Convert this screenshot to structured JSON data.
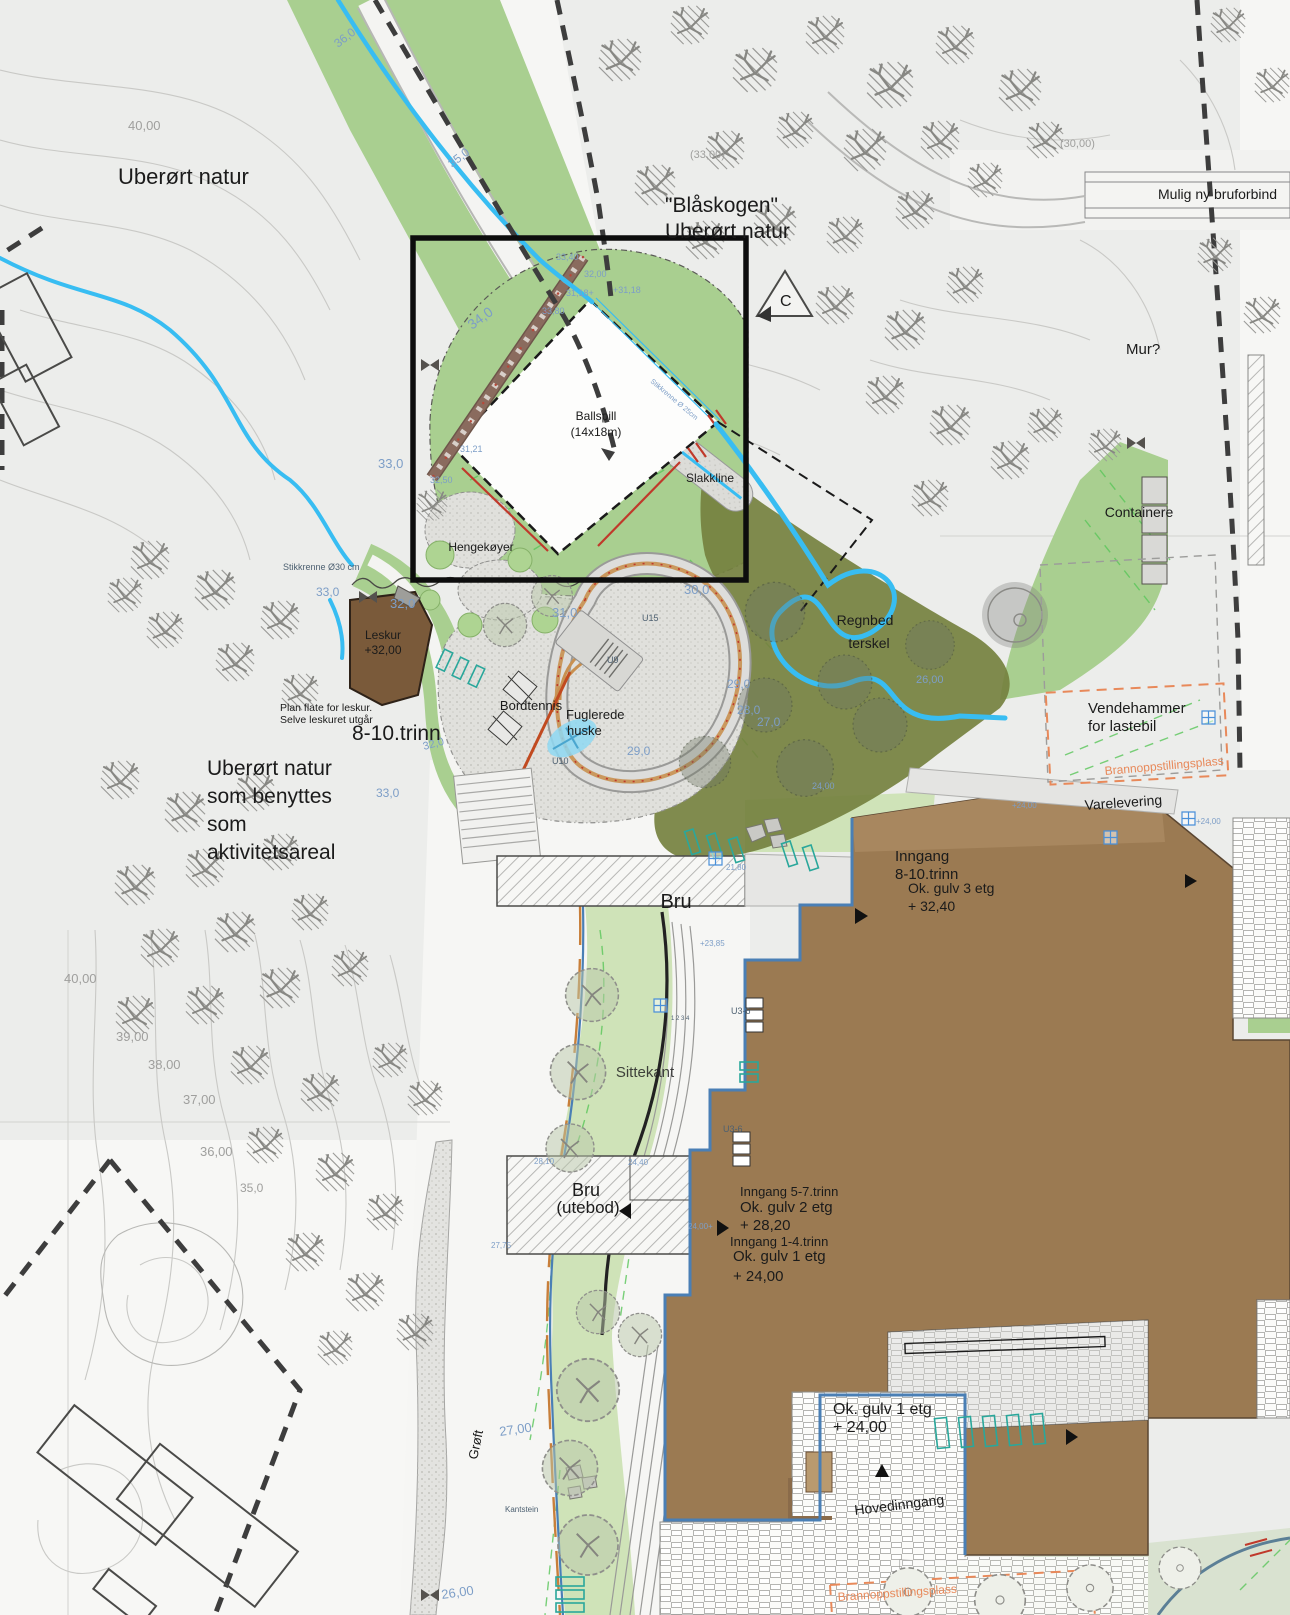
{
  "colors": {
    "terrain": "#ecedeb",
    "slope_green": "#a9cf90",
    "lawn_green": "#cfe3b8",
    "pale_green": "#d9e2d0",
    "rain_garden_olive": "#75813f",
    "water_blue": "#38bdf2",
    "building_brown": "#9b7a52",
    "building_brown_light": "#a8875f",
    "leskur_brown": "#7a5a3a",
    "accent_orange": "#e8895a",
    "curb_orange": "#c87f3a",
    "track_tan": "#c89050",
    "red_line": "#c0392b",
    "boundary_dark": "#3d3d3d",
    "elevation_blue": "#7d9ec7",
    "contour_grey": "#9f9f9d"
  },
  "labels": {
    "uberort_natur_top": "Uberørt natur",
    "blaskogen_1": "\"Blåskogen\"",
    "blaskogen_2": "Uberørt natur",
    "mulig_ny_bru": "Mulig ny bruforbind",
    "mur": "Mur?",
    "section_c": "C",
    "ballspill_1": "Ballspill",
    "ballspill_2": "(14x18m)",
    "slakkline": "Slakkline",
    "hengekoyer": "Hengekøyer",
    "leskur_1": "Leskur",
    "leskur_2": "+32,00",
    "plan_flate_1": "Plan flate for leskur.",
    "plan_flate_2": "Selve leskuret utgår",
    "trinn_8_10": "8-10.trinn",
    "natur_1": "Uberørt natur",
    "natur_2": "som benyttes",
    "natur_3": "som",
    "natur_4": "aktivitetsareal",
    "bordtennis": "Bordtennis",
    "fuglerede_1": "Fuglerede",
    "fuglerede_2": "huske",
    "regnbed_1": "Regnbed",
    "regnbed_2": "terskel",
    "containere": "Containere",
    "vendehammer_1": "Vendehammer",
    "vendehammer_2": "for lastebil",
    "brannoppstillingsplass": "Brannoppstillingsplass",
    "varelevering": "Varelevering",
    "inngang_810_1": "Inngang",
    "inngang_810_2": "8-10.trinn",
    "ok_gulv3_1": "Ok. gulv 3 etg",
    "ok_gulv3_2": "+ 32,40",
    "bru": "Bru",
    "sittekant": "Sittekant",
    "bru_utebod_1": "Bru",
    "bru_utebod_2": "(utebod)",
    "inngang_57": "Inngang 5-7.trinn",
    "ok_gulv2_1": "Ok. gulv 2 etg",
    "ok_gulv2_2": "+ 28,20",
    "inngang_14": "Inngang 1-4.trinn",
    "ok_gulv1_1": "Ok. gulv 1 etg",
    "ok_gulv1_2": "+ 24,00",
    "ok_gulv1b_1": "Ok. gulv 1 etg",
    "ok_gulv1b_2": "+ 24,00",
    "hovedinngang": "Hovedinngang",
    "groft": "Grøft"
  },
  "map": {
    "spot_labels": [
      {
        "t": "40,00",
        "x": 128,
        "y": 130,
        "fs": 13,
        "c": "g"
      },
      {
        "t": "36,0",
        "x": 338,
        "y": 48,
        "fs": 12,
        "c": "b",
        "r": -38
      },
      {
        "t": "35,0",
        "x": 452,
        "y": 168,
        "fs": 12,
        "c": "b",
        "r": -38
      },
      {
        "t": "(33,00)",
        "x": 690,
        "y": 158,
        "fs": 11,
        "c": "g"
      },
      {
        "t": "(30,00)",
        "x": 1060,
        "y": 147,
        "fs": 11,
        "c": "g"
      },
      {
        "t": "34,0",
        "x": 472,
        "y": 330,
        "fs": 14,
        "c": "b",
        "r": -36
      },
      {
        "t": "33,40",
        "x": 556,
        "y": 260,
        "fs": 9,
        "c": "b"
      },
      {
        "t": "32,00",
        "x": 584,
        "y": 277,
        "fs": 9,
        "c": "b"
      },
      {
        "t": "31,18+",
        "x": 566,
        "y": 296,
        "fs": 9,
        "c": "b"
      },
      {
        "t": "+31,18",
        "x": 613,
        "y": 293,
        "fs": 9,
        "c": "b"
      },
      {
        "t": "33,80",
        "x": 542,
        "y": 314,
        "fs": 9,
        "c": "b"
      },
      {
        "t": "31,21",
        "x": 460,
        "y": 452,
        "fs": 9,
        "c": "b"
      },
      {
        "t": "32,50",
        "x": 430,
        "y": 483,
        "fs": 9,
        "c": "b"
      },
      {
        "t": "33,0",
        "x": 378,
        "y": 468,
        "fs": 13,
        "c": "b"
      },
      {
        "t": "33,0",
        "x": 316,
        "y": 596,
        "fs": 12,
        "c": "b"
      },
      {
        "t": "32,0",
        "x": 390,
        "y": 608,
        "fs": 13,
        "c": "b"
      },
      {
        "t": "31,0",
        "x": 552,
        "y": 617,
        "fs": 13,
        "c": "b"
      },
      {
        "t": "30,0",
        "x": 684,
        "y": 594,
        "fs": 13,
        "c": "b"
      },
      {
        "t": "33,0",
        "x": 376,
        "y": 797,
        "fs": 12,
        "c": "b"
      },
      {
        "t": "32,0",
        "x": 424,
        "y": 750,
        "fs": 11,
        "c": "b",
        "r": -15
      },
      {
        "t": "29,0",
        "x": 627,
        "y": 755,
        "fs": 12,
        "c": "b"
      },
      {
        "t": "29,0",
        "x": 727,
        "y": 688,
        "fs": 12,
        "c": "b"
      },
      {
        "t": "28,0",
        "x": 737,
        "y": 714,
        "fs": 12,
        "c": "b"
      },
      {
        "t": "27,0",
        "x": 757,
        "y": 726,
        "fs": 12,
        "c": "b"
      },
      {
        "t": "26,00",
        "x": 916,
        "y": 683,
        "fs": 11,
        "c": "b"
      },
      {
        "t": "24,00",
        "x": 812,
        "y": 789,
        "fs": 9,
        "c": "b"
      },
      {
        "t": "+24,00",
        "x": 1012,
        "y": 808,
        "fs": 8,
        "c": "b"
      },
      {
        "t": "+24,00",
        "x": 1196,
        "y": 824,
        "fs": 8,
        "c": "b"
      },
      {
        "t": "21,80",
        "x": 726,
        "y": 870,
        "fs": 8,
        "c": "b"
      },
      {
        "t": "+23,85",
        "x": 700,
        "y": 946,
        "fs": 8,
        "c": "b"
      },
      {
        "t": "28,10",
        "x": 534,
        "y": 1164,
        "fs": 8,
        "c": "b"
      },
      {
        "t": "24,40",
        "x": 628,
        "y": 1165,
        "fs": 8,
        "c": "b"
      },
      {
        "t": "27,75",
        "x": 491,
        "y": 1248,
        "fs": 8,
        "c": "b"
      },
      {
        "t": "24,00+",
        "x": 688,
        "y": 1229,
        "fs": 8,
        "c": "b"
      },
      {
        "t": "27,00",
        "x": 500,
        "y": 1436,
        "fs": 13,
        "c": "b",
        "r": -8
      },
      {
        "t": "26,00",
        "x": 442,
        "y": 1599,
        "fs": 13,
        "c": "b",
        "r": -8
      },
      {
        "t": "40,00",
        "x": 64,
        "y": 983,
        "fs": 13,
        "c": "g"
      },
      {
        "t": "39,00",
        "x": 116,
        "y": 1041,
        "fs": 13,
        "c": "g"
      },
      {
        "t": "38,00",
        "x": 148,
        "y": 1069,
        "fs": 13,
        "c": "g"
      },
      {
        "t": "37,00",
        "x": 183,
        "y": 1104,
        "fs": 13,
        "c": "g"
      },
      {
        "t": "36,00",
        "x": 200,
        "y": 1156,
        "fs": 13,
        "c": "g"
      },
      {
        "t": "35,0",
        "x": 240,
        "y": 1192,
        "fs": 12,
        "c": "g"
      },
      {
        "t": "Stikkrenne Ø30 cm",
        "x": 283,
        "y": 570,
        "fs": 9,
        "c": "d"
      },
      {
        "t": "Stikkrenne Ø 25cm",
        "x": 650,
        "y": 382,
        "fs": 7,
        "c": "b",
        "r": 40
      },
      {
        "t": "Kantstein",
        "x": 505,
        "y": 1512,
        "fs": 8,
        "c": "d"
      },
      {
        "t": "1 2 3 4",
        "x": 671,
        "y": 1020,
        "fs": 6,
        "c": "d"
      },
      {
        "t": "U9",
        "x": 607,
        "y": 663,
        "fs": 9,
        "c": "d"
      },
      {
        "t": "U15",
        "x": 642,
        "y": 621,
        "fs": 9,
        "c": "d"
      },
      {
        "t": "U10",
        "x": 552,
        "y": 764,
        "fs": 9,
        "c": "d"
      },
      {
        "t": "U3-6",
        "x": 731,
        "y": 1014,
        "fs": 9,
        "c": "d"
      },
      {
        "t": "U3-6",
        "x": 723,
        "y": 1132,
        "fs": 9,
        "c": "d"
      }
    ],
    "trees": [
      {
        "v": "h",
        "x": 620,
        "y": 60,
        "s": 1.1
      },
      {
        "v": "h",
        "x": 690,
        "y": 25,
        "s": 1
      },
      {
        "v": "h",
        "x": 755,
        "y": 70,
        "s": 1.15
      },
      {
        "v": "h",
        "x": 825,
        "y": 35,
        "s": 1
      },
      {
        "v": "h",
        "x": 890,
        "y": 85,
        "s": 1.2
      },
      {
        "v": "h",
        "x": 955,
        "y": 45,
        "s": 1
      },
      {
        "v": "h",
        "x": 1020,
        "y": 90,
        "s": 1.1
      },
      {
        "v": "h",
        "x": 940,
        "y": 140,
        "s": 1
      },
      {
        "v": "h",
        "x": 865,
        "y": 150,
        "s": 1.1
      },
      {
        "v": "h",
        "x": 795,
        "y": 130,
        "s": 0.95
      },
      {
        "v": "h",
        "x": 725,
        "y": 150,
        "s": 1
      },
      {
        "v": "h",
        "x": 655,
        "y": 185,
        "s": 1.05
      },
      {
        "v": "h",
        "x": 705,
        "y": 240,
        "s": 1
      },
      {
        "v": "h",
        "x": 775,
        "y": 225,
        "s": 1.1
      },
      {
        "v": "h",
        "x": 845,
        "y": 235,
        "s": 0.95
      },
      {
        "v": "h",
        "x": 915,
        "y": 210,
        "s": 1
      },
      {
        "v": "h",
        "x": 985,
        "y": 180,
        "s": 0.9
      },
      {
        "v": "h",
        "x": 1045,
        "y": 140,
        "s": 0.95
      },
      {
        "v": "h",
        "x": 835,
        "y": 305,
        "s": 1
      },
      {
        "v": "h",
        "x": 905,
        "y": 330,
        "s": 1.05
      },
      {
        "v": "h",
        "x": 965,
        "y": 285,
        "s": 0.95
      },
      {
        "v": "h",
        "x": 1228,
        "y": 25,
        "s": 0.9
      },
      {
        "v": "h",
        "x": 1272,
        "y": 85,
        "s": 0.9
      },
      {
        "v": "h",
        "x": 1215,
        "y": 255,
        "s": 0.9
      },
      {
        "v": "h",
        "x": 1262,
        "y": 315,
        "s": 0.95
      },
      {
        "v": "h",
        "x": 885,
        "y": 395,
        "s": 1
      },
      {
        "v": "h",
        "x": 950,
        "y": 425,
        "s": 1.05
      },
      {
        "v": "h",
        "x": 1010,
        "y": 460,
        "s": 1
      },
      {
        "v": "h",
        "x": 930,
        "y": 498,
        "s": 0.95
      },
      {
        "v": "h",
        "x": 1045,
        "y": 425,
        "s": 0.9
      },
      {
        "v": "h",
        "x": 1105,
        "y": 445,
        "s": 0.85
      },
      {
        "v": "h",
        "x": 150,
        "y": 560,
        "s": 1
      },
      {
        "v": "h",
        "x": 215,
        "y": 590,
        "s": 1.05
      },
      {
        "v": "h",
        "x": 280,
        "y": 620,
        "s": 1
      },
      {
        "v": "h",
        "x": 165,
        "y": 630,
        "s": 0.95
      },
      {
        "v": "h",
        "x": 235,
        "y": 662,
        "s": 1
      },
      {
        "v": "h",
        "x": 300,
        "y": 692,
        "s": 0.95
      },
      {
        "v": "h",
        "x": 125,
        "y": 595,
        "s": 0.9
      },
      {
        "v": "h",
        "x": 120,
        "y": 780,
        "s": 1
      },
      {
        "v": "h",
        "x": 185,
        "y": 812,
        "s": 1.05
      },
      {
        "v": "h",
        "x": 255,
        "y": 792,
        "s": 1
      },
      {
        "v": "h",
        "x": 135,
        "y": 885,
        "s": 1.05
      },
      {
        "v": "h",
        "x": 205,
        "y": 868,
        "s": 1
      },
      {
        "v": "h",
        "x": 280,
        "y": 852,
        "s": 0.95
      },
      {
        "v": "h",
        "x": 160,
        "y": 948,
        "s": 1
      },
      {
        "v": "h",
        "x": 235,
        "y": 932,
        "s": 1.05
      },
      {
        "v": "h",
        "x": 310,
        "y": 912,
        "s": 0.95
      },
      {
        "v": "h",
        "x": 135,
        "y": 1015,
        "s": 1
      },
      {
        "v": "h",
        "x": 205,
        "y": 1005,
        "s": 1
      },
      {
        "v": "h",
        "x": 280,
        "y": 988,
        "s": 1.05
      },
      {
        "v": "h",
        "x": 350,
        "y": 968,
        "s": 0.95
      },
      {
        "v": "h",
        "x": 390,
        "y": 1060,
        "s": 0.9
      },
      {
        "v": "h",
        "x": 425,
        "y": 1098,
        "s": 0.9
      },
      {
        "v": "h",
        "x": 250,
        "y": 1065,
        "s": 1
      },
      {
        "v": "h",
        "x": 320,
        "y": 1092,
        "s": 1
      },
      {
        "v": "h",
        "x": 265,
        "y": 1145,
        "s": 0.95
      },
      {
        "v": "h",
        "x": 335,
        "y": 1172,
        "s": 1
      },
      {
        "v": "h",
        "x": 385,
        "y": 1212,
        "s": 0.95
      },
      {
        "v": "h",
        "x": 305,
        "y": 1252,
        "s": 1
      },
      {
        "v": "h",
        "x": 365,
        "y": 1292,
        "s": 1
      },
      {
        "v": "h",
        "x": 415,
        "y": 1332,
        "s": 0.95
      },
      {
        "v": "h",
        "x": 335,
        "y": 1348,
        "s": 0.9
      },
      {
        "v": "h",
        "x": 432,
        "y": 505,
        "s": 0.8
      },
      {
        "v": "o",
        "x": 592,
        "y": 995,
        "s": 1.1
      },
      {
        "v": "o",
        "x": 578,
        "y": 1072,
        "s": 1.15
      },
      {
        "v": "o",
        "x": 570,
        "y": 1148,
        "s": 1
      },
      {
        "v": "o",
        "x": 598,
        "y": 1312,
        "s": 0.9
      },
      {
        "v": "o",
        "x": 588,
        "y": 1390,
        "s": 1.3
      },
      {
        "v": "o",
        "x": 570,
        "y": 1468,
        "s": 1.15
      },
      {
        "v": "o",
        "x": 588,
        "y": 1545,
        "s": 1.25
      },
      {
        "v": "o",
        "x": 640,
        "y": 1335,
        "s": 0.9
      },
      {
        "v": "o",
        "x": 505,
        "y": 625,
        "s": 0.9
      },
      {
        "v": "o",
        "x": 552,
        "y": 596,
        "s": 0.85
      },
      {
        "v": "r",
        "x": 908,
        "y": 1592,
        "s": 1.1
      },
      {
        "v": "r",
        "x": 1000,
        "y": 1600,
        "s": 1.15
      },
      {
        "v": "r",
        "x": 1090,
        "y": 1588,
        "s": 1.05
      },
      {
        "v": "r",
        "x": 1180,
        "y": 1568,
        "s": 0.95
      },
      {
        "v": "g",
        "x": 775,
        "y": 612,
        "s": 1.1
      },
      {
        "v": "g",
        "x": 845,
        "y": 682,
        "s": 1
      },
      {
        "v": "g",
        "x": 765,
        "y": 705,
        "s": 1
      },
      {
        "v": "g",
        "x": 705,
        "y": 762,
        "s": 0.95
      },
      {
        "v": "g",
        "x": 805,
        "y": 768,
        "s": 1.05
      },
      {
        "v": "g",
        "x": 880,
        "y": 725,
        "s": 1
      },
      {
        "v": "g",
        "x": 930,
        "y": 645,
        "s": 0.9
      }
    ]
  }
}
